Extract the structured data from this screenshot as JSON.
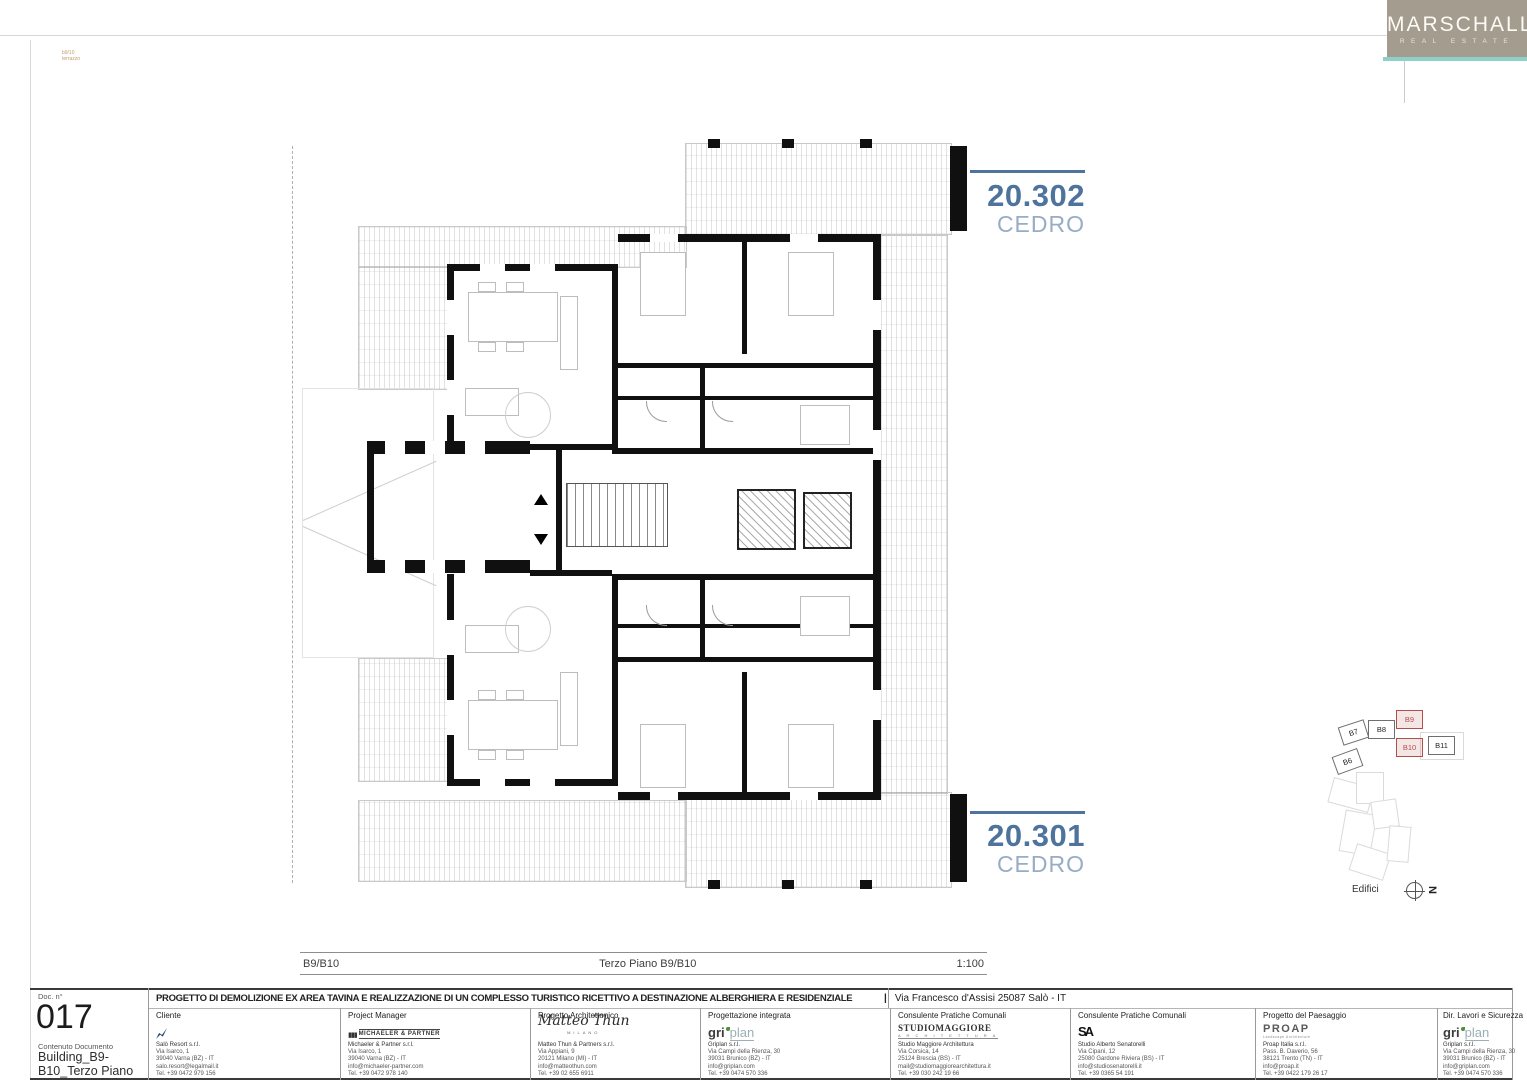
{
  "brand": {
    "name": "MARSCHALL",
    "tagline": "REAL ESTATE",
    "bg_color": "#a49c8f",
    "accent_color": "#8ed1ca"
  },
  "stamp": {
    "line1": "b9/10",
    "line2": "terrazzo"
  },
  "plan": {
    "unit_top": {
      "code": "20.302",
      "name": "CEDRO"
    },
    "unit_bottom": {
      "code": "20.301",
      "name": "CEDRO"
    },
    "label_color": "#4e739c",
    "scale_left": "B9/B10",
    "scale_center": "Terzo Piano B9/B10",
    "scale_right": "1:100"
  },
  "sitemap": {
    "caption": "Edifici",
    "north_label": "N",
    "highlight_color": "#b0504a",
    "buildings": [
      {
        "id": "B7",
        "highlight": false
      },
      {
        "id": "B8",
        "highlight": false
      },
      {
        "id": "B9",
        "highlight": true
      },
      {
        "id": "B10",
        "highlight": true
      },
      {
        "id": "B11",
        "highlight": false
      },
      {
        "id": "B6",
        "highlight": false
      }
    ]
  },
  "titleblock": {
    "doc_label": "Doc. n°",
    "doc_number": "017",
    "content_label": "Contenuto Documento",
    "content_line1": "Building_B9-",
    "content_line2": "B10_Terzo Piano",
    "project_title": "PROGETTO DI DEMOLIZIONE  EX AREA TAVINA E REALIZZAZIONE  DI UN COMPLESSO TURISTICO RICETTIVO A DESTINAZIONE ALBERGHIERA E RESIDENZIALE",
    "divider": "|",
    "address": "Via Francesco d'Assisi 25087 Salò - IT",
    "columns": [
      {
        "role": "Cliente",
        "logo_text": "",
        "logo_sub": "",
        "lines": [
          "Salò Resort s.r.l.",
          "Via Isarco, 1",
          "39040 Varna (BZ) - IT",
          "salo.resort@legalmail.it",
          "Tel. +39 0472 979 156"
        ]
      },
      {
        "role": "Project Manager",
        "logo_text": "MICHAELER & PARTNER",
        "logo_sub": "",
        "lines": [
          "Michaeler & Partner s.r.l.",
          "Via Isarco, 1",
          "39040 Varna (BZ) - IT",
          "info@michaeler-partner.com",
          "Tel. +39 0472 978 140"
        ]
      },
      {
        "role": "Progetto Architettonico",
        "logo_text": "Matteo Thun",
        "logo_sub": "MILANO",
        "lines": [
          "Matteo Thun & Partners s.r.l.",
          "Via Appiani, 9",
          "20121 Milano (MI) - IT",
          "info@matteothun.com",
          "Tel. +39 02 655 6911"
        ]
      },
      {
        "role": "Progettazione integrata",
        "logo_text": "griplan",
        "logo_sub": "",
        "lines": [
          "Griplan s.r.l.",
          "Via Campi della Rienza, 30",
          "39031 Brunico (BZ) - IT",
          "info@griplan.com",
          "Tel. +39 0474 570 336"
        ]
      },
      {
        "role": "Consulente Pratiche Comunali",
        "logo_text": "STUDIOMAGGIORE",
        "logo_sub": "A R C H I T E T T U R A",
        "lines": [
          "Studio Maggiore Architettura",
          "Via Corsica, 14",
          "25124 Brescia (BS) - IT",
          "mail@studiomaggiorearchitettura.it",
          "Tel. +39 030 242 19 66"
        ]
      },
      {
        "role": "Consulente Pratiche Comunali",
        "logo_text": "SA",
        "logo_sub": "",
        "lines": [
          "Studio Alberto Senatorelli",
          "Via Cipani, 12",
          "25080 Gardone Riviera (BS) - IT",
          "info@studiosenatorelli.it",
          "Tel. +39 0365 54 191"
        ]
      },
      {
        "role": "Progetto del Paesaggio",
        "logo_text": "PROAP",
        "logo_sub": "Landscape Architecture",
        "lines": [
          "Proap Italia s.r.l.",
          "Pass. B. Daverio, 56",
          "38121 Trento (TN) - IT",
          "info@proap.it",
          "Tel. +39 0422 179 26 17"
        ]
      },
      {
        "role": "Dir. Lavori e Sicurezza",
        "logo_text": "griplan",
        "logo_sub": "",
        "lines": [
          "Griplan s.r.l.",
          "Via Campi della Rienza, 30",
          "39031 Brunico (BZ) - IT",
          "info@griplan.com",
          "Tel. +39 0474 570 336"
        ]
      }
    ]
  }
}
